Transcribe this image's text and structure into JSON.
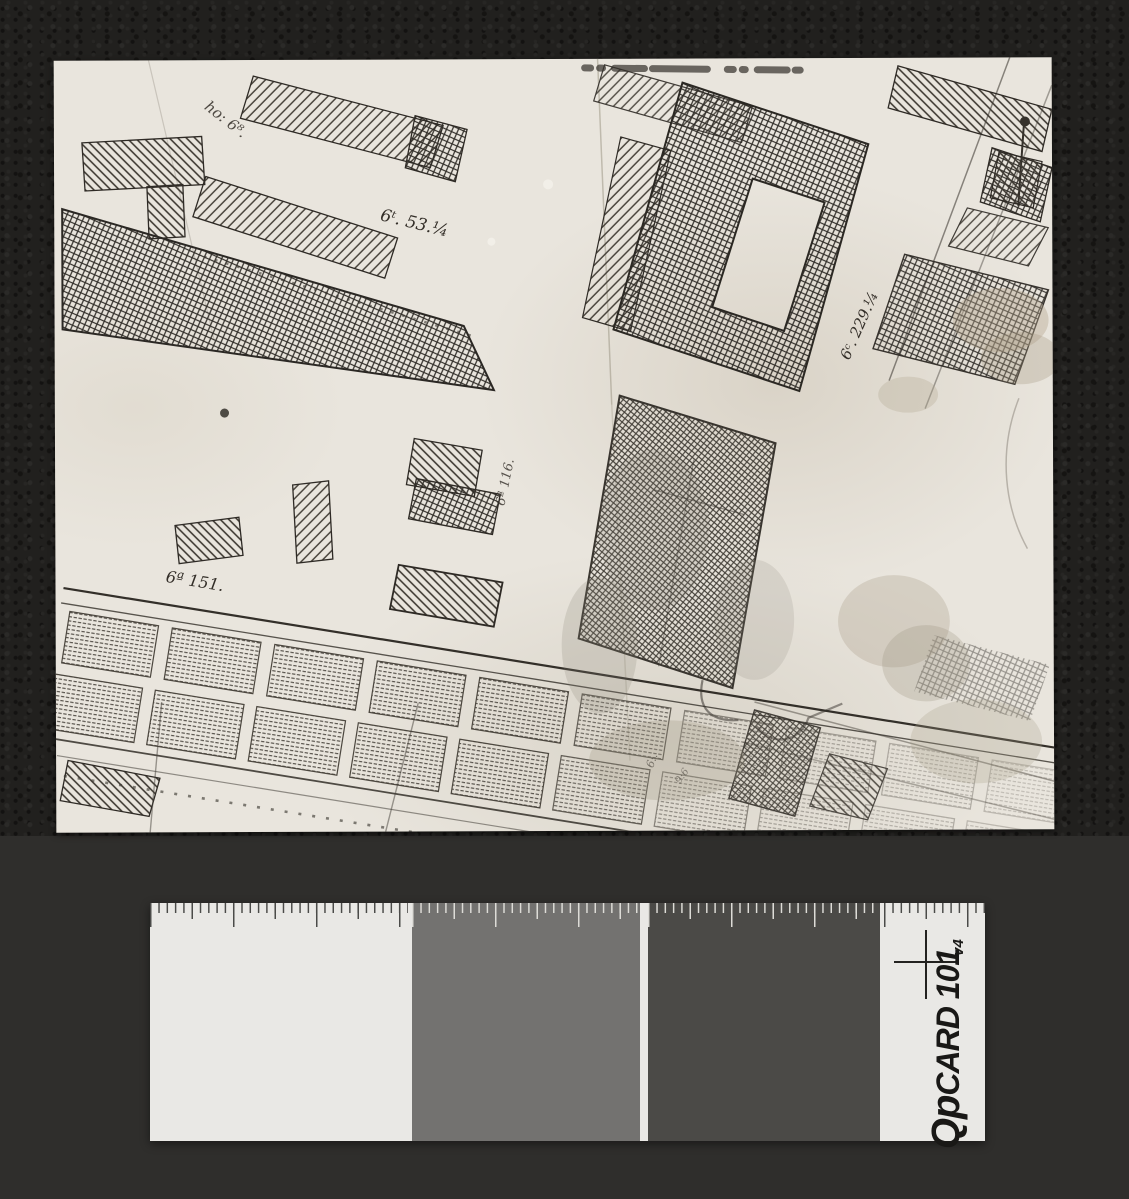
{
  "scene": {
    "description": "archival photograph of a hand-drawn cadastral map lying on dark leather, with a QPcard 101 grey-scale calibration card below",
    "background": {
      "leather_color": "#21201e",
      "board_color": "#2f2e2c"
    }
  },
  "photo": {
    "paper_color": "#e9e5dd",
    "annotations": [
      {
        "text": "ho: 6⁸."
      },
      {
        "text": "6ᵗ. 53.¼"
      },
      {
        "text": "6ᶜ. 229.¼"
      },
      {
        "text": "6ª 116."
      },
      {
        "text": "6ª 151."
      },
      {
        "text": "6:."
      },
      {
        "text": "9:6"
      }
    ]
  },
  "qpcard": {
    "brand_prefix": "Qp",
    "brand_suffix": "CARD 101",
    "version": "v4",
    "patches": {
      "white": "#e9e8e5",
      "mid_gray": "#737270",
      "dark_gray": "#4b4a47"
    }
  }
}
